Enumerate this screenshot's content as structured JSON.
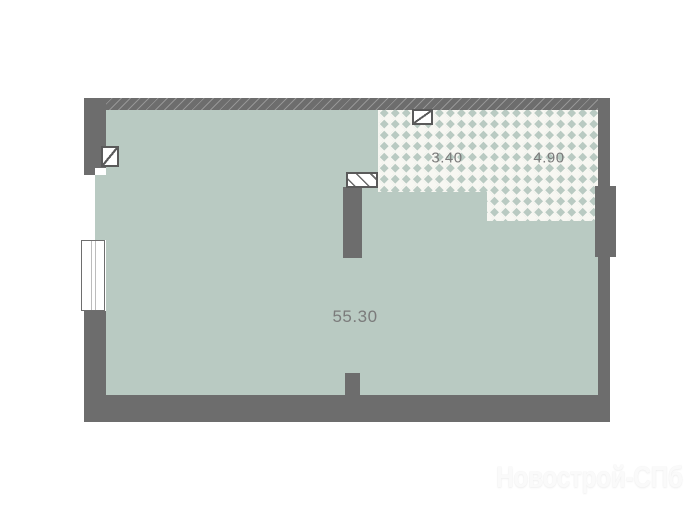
{
  "plan": {
    "rooms": [
      {
        "id": "living-room",
        "area": "55.30"
      },
      {
        "id": "tiled-room-left",
        "area": "3.40"
      },
      {
        "id": "tiled-room-right",
        "area": "4.90"
      }
    ],
    "symbols": {
      "vent_shaft_1": "vent-shaft-icon",
      "vent_shaft_2": "vent-shaft-icon",
      "glazed_partition": "glazed-partition-icon",
      "window": "window-icon"
    },
    "colors": {
      "floor": "#b9cac2",
      "wall": "#6d6d6d",
      "tile_background": "#f7f7f2",
      "tile_diamond": "#b9cac2",
      "label_text": "#7b7b7b",
      "background": "#ffffff"
    }
  },
  "watermark": {
    "text": "Новострой-СПб"
  }
}
